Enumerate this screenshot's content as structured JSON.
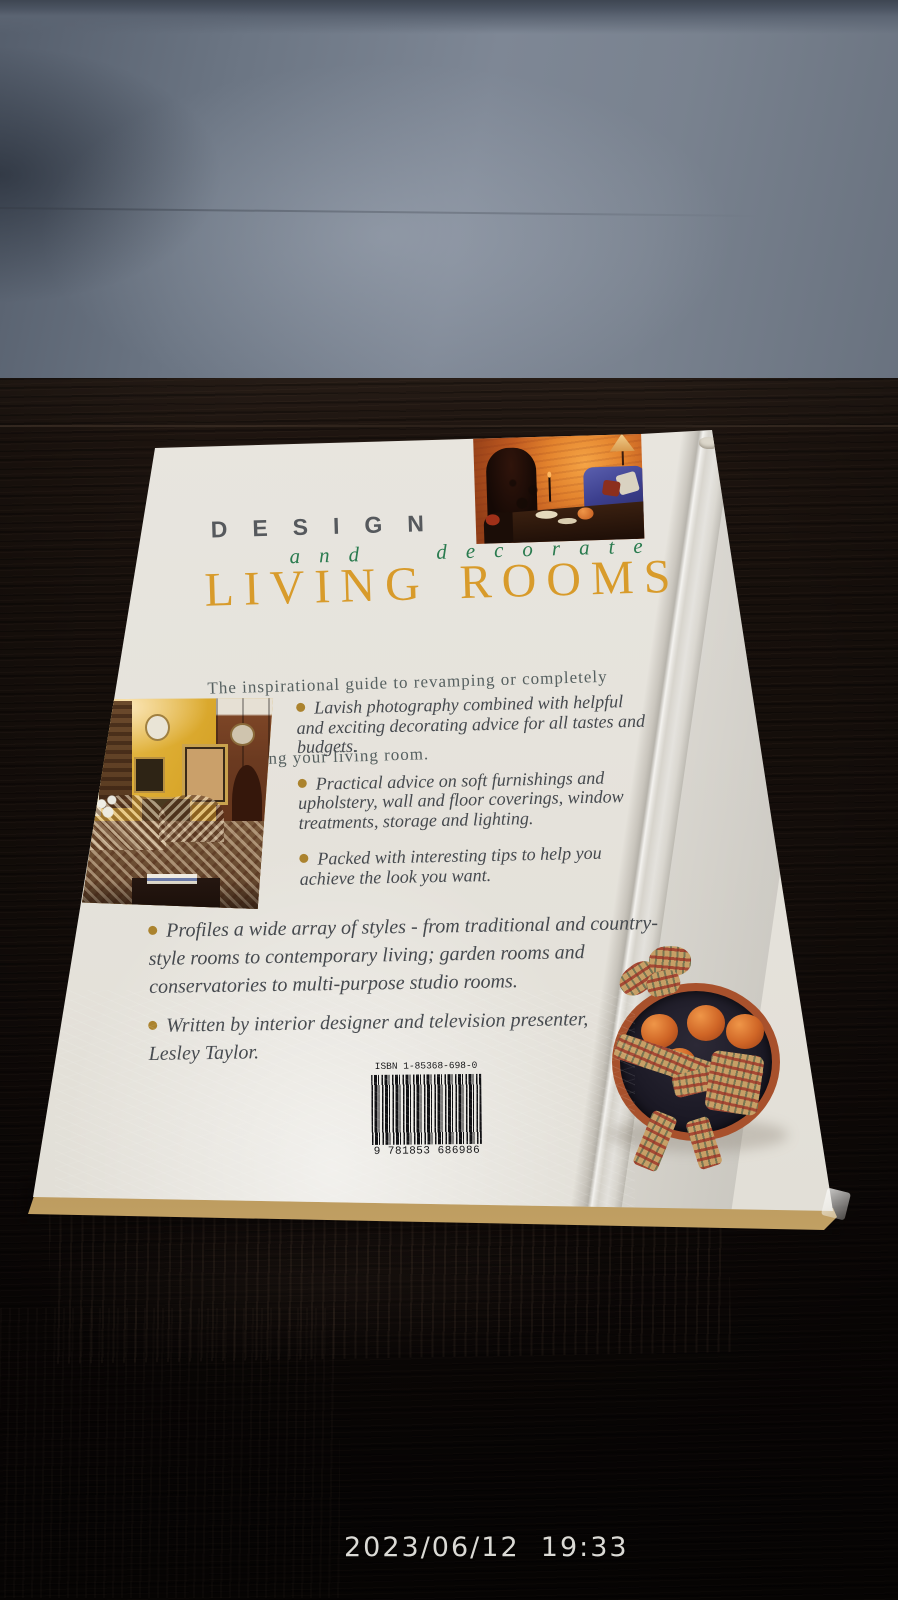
{
  "scene": {
    "timestamp": "2023/06/12  19:33"
  },
  "book_cover": {
    "series_title": "DESIGN",
    "series_subtitle": "and decorate",
    "main_title": "LIVING ROOMS",
    "tagline": {
      "line1": "The inspirational guide to revamping or completely",
      "line2": "recreating your living room."
    },
    "bullets": [
      {
        "lines": [
          "Lavish photography combined with helpful",
          "and exciting decorating advice for all tastes and",
          "budgets."
        ]
      },
      {
        "lines": [
          "Practical advice on soft furnishings and",
          "upholstery, wall and floor coverings, window",
          "treatments, storage and lighting."
        ]
      },
      {
        "lines": [
          "Packed with interesting tips to help you",
          "achieve the look you want."
        ]
      },
      {
        "lines": [
          "Profiles a wide array of styles - from traditional and country-",
          "style rooms to contemporary living; garden rooms and",
          "conservatories to multi-purpose studio rooms."
        ]
      },
      {
        "lines": [
          "Written by interior designer and television presenter,",
          "Lesley Taylor."
        ]
      }
    ],
    "isbn_label": "ISBN 1-85368-698-0",
    "barcode_digits": "9 781853 686986",
    "colors": {
      "main_title_orange": "#D89B2B",
      "subtitle_green": "#2A7B4F",
      "series_gray": "#56595D",
      "cover_offwhite": "#E6E3DC",
      "page_edge_gold": "#9A7840",
      "wall_gray_blue": "#7E8795",
      "table_dark_wood": "#140D0A"
    },
    "photos": {
      "top_right": "fireplace-living-room-photo",
      "left": "country-style-living-room-photo",
      "bottom_right": "oranges-tartan-plate-photo"
    }
  }
}
